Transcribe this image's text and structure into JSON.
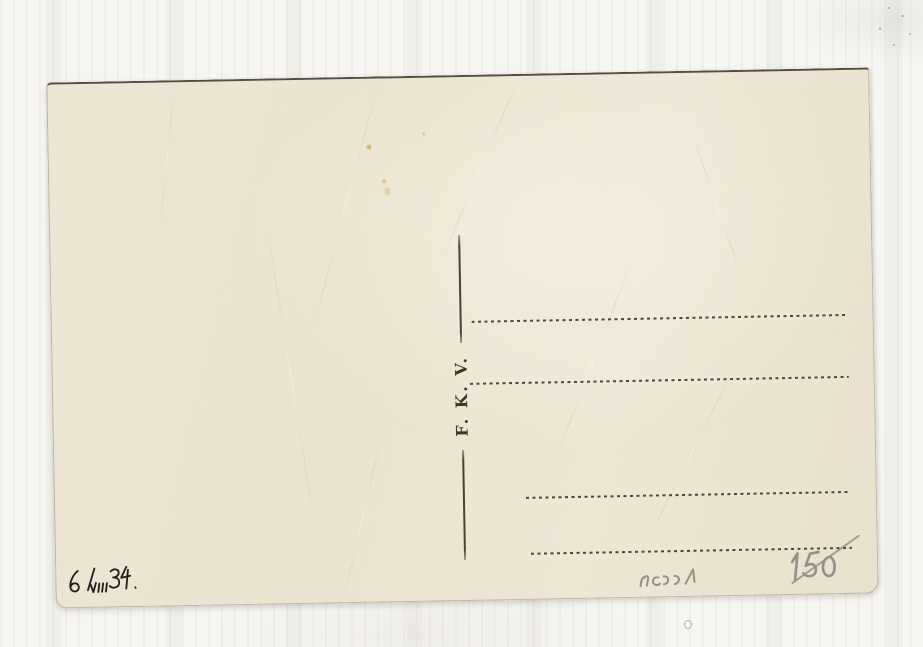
{
  "card": {
    "publisher_mark": "F. K. V.",
    "handwritten_date": "6/VIII 34.",
    "pencil_code": "ncɔɔ1",
    "pencil_price": "150",
    "address_line_count": 4,
    "colors": {
      "card_paper": "#ece5d3",
      "printed_ink": "#3e382d",
      "handwriting_ink": "#211d17",
      "pencil": "#93908a",
      "scan_background": "#f6f5f1"
    }
  }
}
